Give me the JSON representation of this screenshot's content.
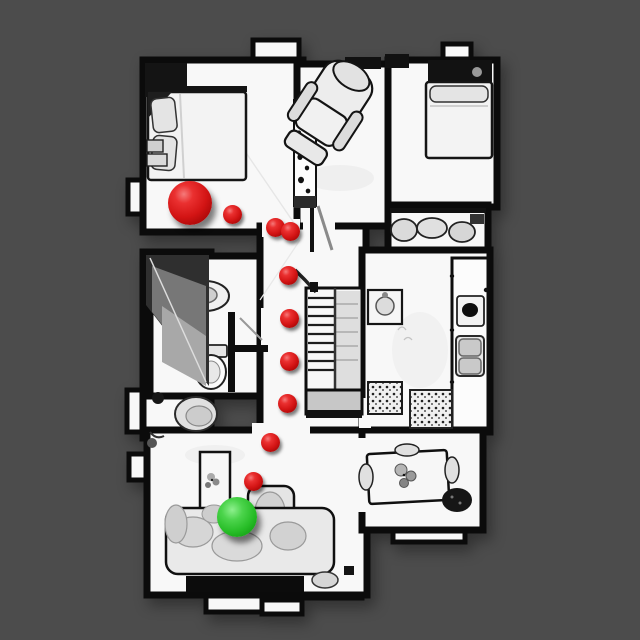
{
  "scene": {
    "description": "top-down rendered 3D scan of a house interior with a navigation path overlay",
    "background_color": "#4c4c4c",
    "floor_color": "#f8f8f8",
    "wall_color": "#0b0b0b"
  },
  "markers": {
    "start": {
      "label": "start-position-sphere",
      "color": "#d31414",
      "x": 190,
      "y": 203,
      "radius": 22
    },
    "goal": {
      "label": "goal-position-sphere",
      "color": "#27bd27",
      "x": 237,
      "y": 517,
      "radius": 20
    },
    "waypoints": {
      "color": "#d31414",
      "radius": 9.5,
      "points": [
        {
          "x": 232,
          "y": 214
        },
        {
          "x": 275,
          "y": 227
        },
        {
          "x": 290,
          "y": 231
        },
        {
          "x": 288,
          "y": 275
        },
        {
          "x": 289,
          "y": 318
        },
        {
          "x": 289,
          "y": 361
        },
        {
          "x": 287,
          "y": 403
        },
        {
          "x": 270,
          "y": 442
        },
        {
          "x": 253,
          "y": 481
        }
      ]
    }
  }
}
